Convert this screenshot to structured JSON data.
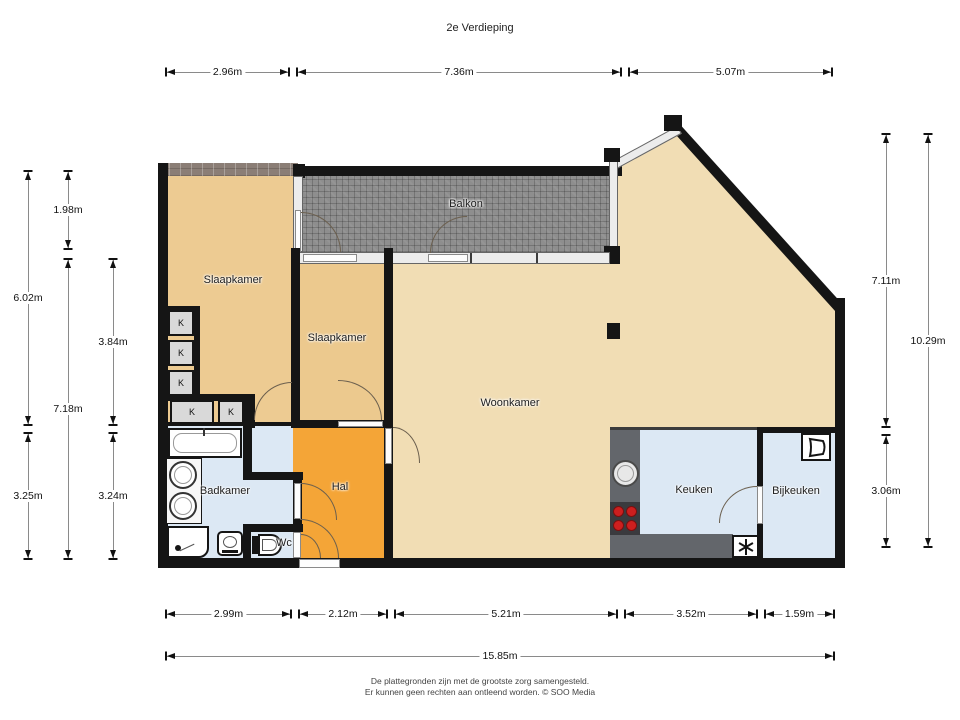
{
  "title": "2e Verdieping",
  "labels": {
    "bedroom1": "Slaapkamer",
    "bedroom2": "Slaapkamer",
    "balcony": "Balkon",
    "living": "Woonkamer",
    "hall": "Hal",
    "bathroom": "Badkamer",
    "wc": "Wc",
    "kitchen": "Keuken",
    "utility": "Bijkeuken",
    "closet": "K"
  },
  "dimensions": {
    "top": [
      "2.96m",
      "7.36m",
      "5.07m"
    ],
    "bottom": [
      "2.99m",
      "2.12m",
      "5.21m",
      "3.52m",
      "1.59m"
    ],
    "bottom_total": "15.85m",
    "left": [
      "1.98m",
      "6.02m",
      "3.84m",
      "7.18m",
      "3.25m",
      "3.24m"
    ],
    "right": [
      "7.11m",
      "10.29m",
      "3.06m"
    ]
  },
  "footer": {
    "line1": "De plattegronden zijn met de grootste zorg samengesteld.",
    "line2": "Er kunnen geen rechten aan ontleend worden. © SOO Media"
  },
  "colors": {
    "wall": "#151515",
    "bedroom": "#edcb92",
    "living": "#f1ddb4",
    "hall": "#f4a537",
    "wet_rooms": "#dce8f4",
    "balcony_tile": "#8e8e8e",
    "counter": "#63666b",
    "stove_burner": "#cc1f1f"
  }
}
